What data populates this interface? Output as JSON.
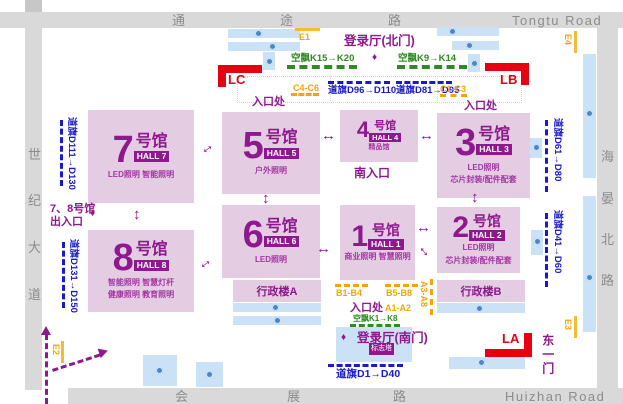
{
  "roads": {
    "top": {
      "zh": [
        "通",
        "途",
        "路"
      ],
      "en": "Tongtu Road"
    },
    "bottom": {
      "zh": [
        "会",
        "展",
        "路"
      ],
      "en": "Huizhan Road"
    },
    "left": {
      "zh": [
        "世",
        "纪",
        "大",
        "道"
      ]
    },
    "right": {
      "zh": [
        "海",
        "晏",
        "北",
        "路"
      ]
    }
  },
  "halls": [
    {
      "num": "7",
      "unit": "号馆",
      "badge": "HALL 7",
      "lines": [
        "LED照明 智能照明"
      ]
    },
    {
      "num": "5",
      "unit": "号馆",
      "badge": "HALL 5",
      "lines": [
        "户外照明"
      ]
    },
    {
      "num": "4",
      "unit": "号馆",
      "badge": "HALL 4",
      "lines": [
        "精品馆"
      ]
    },
    {
      "num": "3",
      "unit": "号馆",
      "badge": "HALL 3",
      "lines": [
        "LED照明",
        "芯片封装/配件配套"
      ]
    },
    {
      "num": "8",
      "unit": "号馆",
      "badge": "HALL 8",
      "lines": [
        "智能照明 智慧灯杆",
        "健康照明 教育照明"
      ]
    },
    {
      "num": "6",
      "unit": "号馆",
      "badge": "HALL 6",
      "lines": [
        "LED照明"
      ]
    },
    {
      "num": "1",
      "unit": "号馆",
      "badge": "HALL 1",
      "lines": [
        "商业照明 智慧照明"
      ]
    },
    {
      "num": "2",
      "unit": "号馆",
      "badge": "HALL 2",
      "lines": [
        "LED照明",
        "芯片封装/配件配套"
      ]
    }
  ],
  "buildings": {
    "admin_a": "行政楼A",
    "admin_b": "行政楼B",
    "landmark": "标志塔"
  },
  "gates": {
    "north_hall": "登录厅(北门)",
    "south_hall": "登录厅(南门)",
    "east_gate": "东一门",
    "south_entrance": "南入口",
    "halls78_line1": "7、8号馆",
    "halls78_line2": "出入口",
    "entrance": "入口处"
  },
  "flags": {
    "d96": "道旗D96→D110",
    "d81": "道旗D81→D95",
    "d111": "道旗D111→D130",
    "d131": "道旗D131→D150",
    "d61": "道旗D61→D80",
    "d41": "道旗D41→D60",
    "d1": "道旗D1→D40"
  },
  "balloons": {
    "k15": "空飘K15→K20",
    "k9": "空飘K9→K14",
    "k1": "空飘K1→K8"
  },
  "booths": {
    "c4": "C4-C6",
    "c1": "C1-C3",
    "b1": "B1-B4",
    "b5": "B5-B8",
    "a1": "A1-A2",
    "a3": "A3-A8"
  },
  "epoints": {
    "e1": "E1",
    "e2": "E2",
    "e3": "E3",
    "e4": "E4"
  },
  "lpoints": {
    "lc": "LC",
    "lb": "LB",
    "la": "LA"
  },
  "glyphs": {
    "h_arrow": "↔",
    "v_arrow": "↕",
    "diamond": "♦"
  },
  "colors": {
    "hall_fill": "#e4cde2",
    "hall_purple": "#8e188e",
    "red": "#e60012",
    "orange": "#f5a50a",
    "green": "#2e8b22",
    "blue": "#1818cc",
    "parking_blue": "#cbe1f5",
    "road_gray": "#d9d9d9"
  }
}
